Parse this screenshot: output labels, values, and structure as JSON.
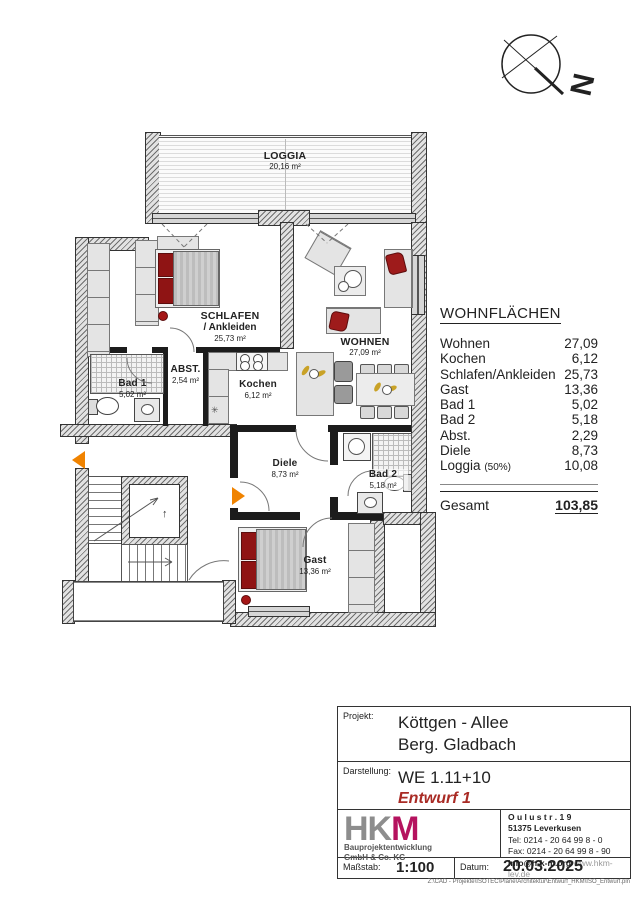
{
  "compass": {
    "north": "N"
  },
  "plan": {
    "rooms": [
      {
        "name": "LOGGIA",
        "area": "20,16 m²"
      },
      {
        "name": "SCHLAFEN",
        "name2": "/ Ankleiden",
        "area": "25,73 m²"
      },
      {
        "name": "WOHNEN",
        "area": "27,09 m²"
      },
      {
        "name": "Bad 1",
        "area": "5,02 m²"
      },
      {
        "name": "ABST.",
        "area": "2,54 m²"
      },
      {
        "name": "Kochen",
        "area": "6,12 m²"
      },
      {
        "name": "Diele",
        "area": "8,73 m²"
      },
      {
        "name": "Bad 2",
        "area": "5,18 m²"
      },
      {
        "name": "Gast",
        "area": "13,36 m²"
      }
    ],
    "icons": {
      "freezer_star": "✳",
      "elevator_up_arrow": "↑"
    }
  },
  "areas_table": {
    "title": "WOHNFLÄCHEN",
    "rows": [
      {
        "label": "Wohnen",
        "value": "27,09"
      },
      {
        "label": "Kochen",
        "value": "6,12"
      },
      {
        "label": "Schlafen/Ankleiden",
        "value": "25,73"
      },
      {
        "label": "Gast",
        "value": "13,36"
      },
      {
        "label": "Bad 1",
        "value": "5,02"
      },
      {
        "label": "Bad 2",
        "value": "5,18"
      },
      {
        "label": "Abst.",
        "value": "2,29"
      },
      {
        "label": "Diele",
        "value": "8,73"
      },
      {
        "label": "Loggia",
        "note": "(50%)",
        "value": "10,08"
      }
    ],
    "total_label": "Gesamt",
    "total_value": "103,85"
  },
  "title_block": {
    "projekt_label": "Projekt:",
    "projekt_line1": "Köttgen - Allee",
    "projekt_line2": "Berg. Gladbach",
    "darstellung_label": "Darstellung:",
    "darstellung_line1": "WE 1.11+10",
    "darstellung_line2": "Entwurf 1",
    "logo": {
      "letters_gray": "HK",
      "letter_accent": "M",
      "company_line1": "Bauprojektentwicklung",
      "company_line2": "GmbH & Co. KG"
    },
    "address": {
      "line1": "O u l u s t r .  1 9",
      "line2": "51375 Leverkusen",
      "tel": "Tel:  0214 - 20 64 99 8 - 0",
      "fax": "Fax: 0214 - 20 64 99 8 - 90",
      "email": "info@h-k-m.org",
      "web": "www.hkm-lev.de"
    },
    "massstab_label": "Maßstab:",
    "massstab_value": "1:100",
    "datum_label": "Datum:",
    "datum_value": "20.03.2025",
    "file_path": "Z:\\CAD - Projekte\\ISOTEC\\Pläne\\Architektur\\Entwurf_HKM\\ISO_Entwurf.pln",
    "colors": {
      "accent_magenta": "#b5135f",
      "entwurf_red": "#a92b25",
      "arrow_orange": "#f08300"
    }
  }
}
